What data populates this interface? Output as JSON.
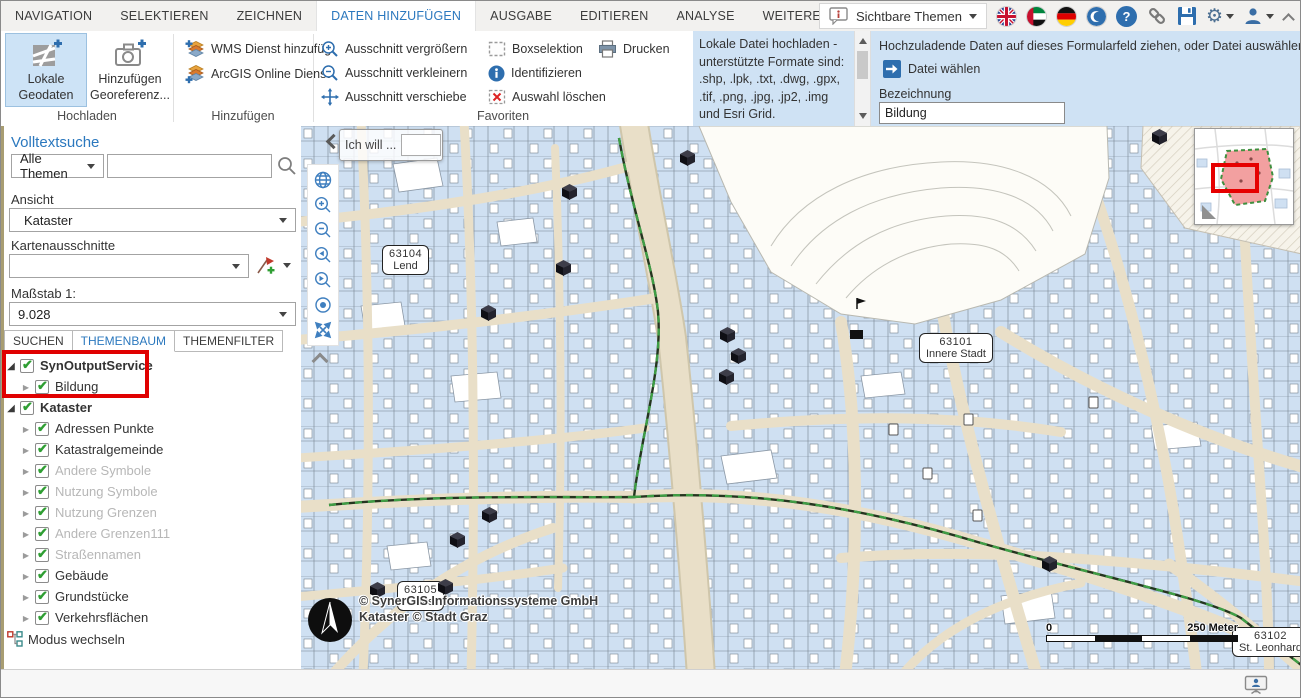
{
  "tab_bar": {
    "tabs": [
      {
        "label": "NAVIGATION"
      },
      {
        "label": "SELEKTIEREN"
      },
      {
        "label": "ZEICHNEN"
      },
      {
        "label": "DATEN HINZUFÜGEN",
        "active": true
      },
      {
        "label": "AUSGABE"
      },
      {
        "label": "EDITIEREN"
      },
      {
        "label": "ANALYSE"
      },
      {
        "label": "WEITERE WERKZEUGE"
      }
    ],
    "visible_themes_label": "Sichtbare Themen"
  },
  "ribbon": {
    "hochladen": {
      "label": "Hochladen",
      "local_geodata": {
        "line1": "Lokale",
        "line2": "Geodaten"
      },
      "georeference": {
        "line1": "Hinzufügen",
        "line2": "Georeferenz..."
      }
    },
    "hinzufuegen": {
      "label": "Hinzufügen",
      "wms": "WMS Dienst hinzufüg",
      "arcgis": "ArcGIS Online Dienst"
    },
    "favoriten": {
      "label": "Favoriten",
      "zoom_in": "Ausschnitt vergrößern",
      "zoom_out": "Ausschnitt verkleinern",
      "pan": "Ausschnitt verschiebe",
      "box_select": "Boxselektion",
      "identify": "Identifizieren",
      "clear_selection": "Auswahl löschen",
      "print": "Drucken"
    },
    "upload_info_text": "Lokale Datei hochladen - unterstützte Formate sind: .shp, .lpk, .txt, .dwg, .gpx, .tif, .png, .jpg, .jp2, .img und Esri Grid.",
    "upload_form": {
      "drop_hint": "Hochzuladende Daten auf dieses Formularfeld ziehen, oder Datei auswählen",
      "choose_file_label": "Datei wählen",
      "name_label": "Bezeichnung",
      "name_value": "Bildung"
    }
  },
  "sidebar": {
    "fulltext_search_title": "Volltextsuche",
    "theme_scope_value": "Alle Themen",
    "search_value": "",
    "view_label": "Ansicht",
    "view_value": "Kataster",
    "map_extents_label": "Kartenausschnitte",
    "map_extents_value": "",
    "scale_label": "Maßstab 1:",
    "scale_value": "9.028",
    "tabs": [
      {
        "label": "SUCHEN"
      },
      {
        "label": "THEMENBAUM",
        "active": true
      },
      {
        "label": "THEMENFILTER"
      }
    ],
    "tree": [
      {
        "label": "SynOutputService",
        "level": 0,
        "bold": true,
        "expanded": true,
        "checked": true
      },
      {
        "label": "Bildung",
        "level": 1,
        "checked": true
      },
      {
        "label": "Kataster",
        "level": 0,
        "bold": true,
        "expanded": true,
        "checked": true
      },
      {
        "label": "Adressen Punkte",
        "level": 1,
        "checked": true
      },
      {
        "label": "Katastralgemeinde",
        "level": 1,
        "checked": true
      },
      {
        "label": "Andere Symbole",
        "level": 1,
        "checked": true,
        "grayed": true
      },
      {
        "label": "Nutzung Symbole",
        "level": 1,
        "checked": true,
        "grayed": true
      },
      {
        "label": "Nutzung Grenzen",
        "level": 1,
        "checked": true,
        "grayed": true
      },
      {
        "label": "Andere Grenzen111",
        "level": 1,
        "checked": true,
        "grayed": true
      },
      {
        "label": "Straßennamen",
        "level": 1,
        "checked": true,
        "grayed": true
      },
      {
        "label": "Gebäude",
        "level": 1,
        "checked": true
      },
      {
        "label": "Grundstücke",
        "level": 1,
        "checked": true
      },
      {
        "label": "Verkehrsflächen",
        "level": 1,
        "checked": true
      }
    ],
    "switch_mode_label": "Modus wechseln"
  },
  "map": {
    "ich_will_label": "Ich will ...",
    "ich_will_value": "",
    "district_labels": [
      {
        "code": "63104",
        "name": "Lend",
        "x": 81,
        "y": 119
      },
      {
        "code": "63101",
        "name": "Innere Stadt",
        "x": 618,
        "y": 207
      },
      {
        "code": "63105",
        "name": "Gries",
        "x": 96,
        "y": 455
      },
      {
        "code": "63102",
        "name": "St. Leonhard",
        "x": 931,
        "y": 501
      }
    ],
    "education_markers": [
      {
        "x": 379,
        "y": 24
      },
      {
        "x": 851,
        "y": 3
      },
      {
        "x": 261,
        "y": 58
      },
      {
        "x": 255,
        "y": 134
      },
      {
        "x": 180,
        "y": 179
      },
      {
        "x": 419,
        "y": 201
      },
      {
        "x": 430,
        "y": 222
      },
      {
        "x": 418,
        "y": 243
      },
      {
        "x": 181,
        "y": 381
      },
      {
        "x": 149,
        "y": 406
      },
      {
        "x": 137,
        "y": 453
      },
      {
        "x": 69,
        "y": 456
      },
      {
        "x": 741,
        "y": 430
      }
    ],
    "copyright": {
      "line1": "© SynerGIS Informationssysteme GmbH",
      "line2": "Kataster © Stadt Graz"
    },
    "scalebar": {
      "start_label": "0",
      "end_label": "250 Meter"
    }
  },
  "colors": {
    "accent_blue": "#2b78be",
    "panel_blue": "#cfe2f4",
    "annotation_red": "#e00000",
    "check_green": "#2f9e33",
    "building_blue": "#cfe0f2",
    "boundary_green": "#2f8f35"
  }
}
